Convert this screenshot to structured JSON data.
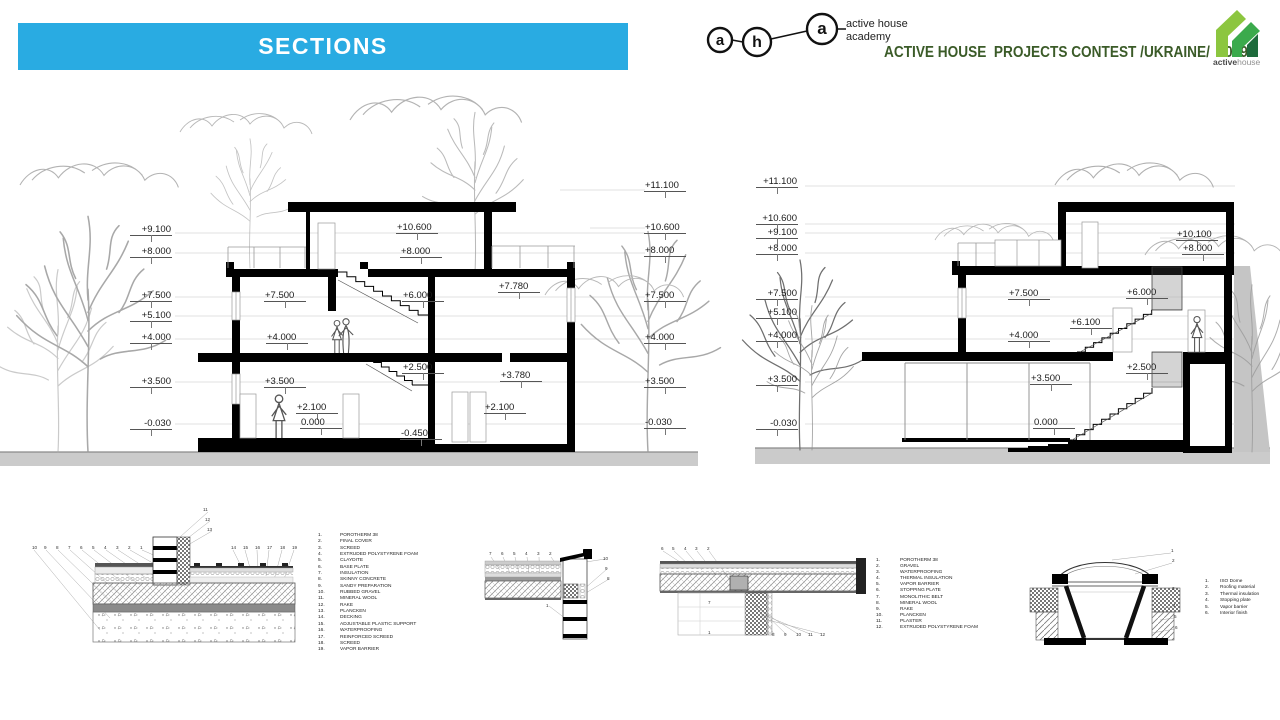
{
  "header": {
    "title": "SECTIONS",
    "aha": {
      "letters": [
        "a",
        "h",
        "a"
      ],
      "caption_line1": "active house",
      "caption_line2": "academy"
    },
    "contest_line": "ACTIVE HOUSE  PROJECTS CONTEST /UKRAINE/  2019",
    "brand": {
      "bold": "active",
      "light": "house"
    },
    "colors": {
      "banner_blue": "#29ABE2",
      "contest_green": "#3B5B28",
      "logo_light_green": "#8CC63F",
      "logo_mid_green": "#3BAA4C",
      "logo_dark_green": "#1E6B3C"
    }
  },
  "sections": [
    {
      "name": "section-1",
      "left_labels": [
        "+9.100",
        "+8.000",
        "+7.500",
        "+5.100",
        "+4.000",
        "+3.500",
        "-0.030"
      ],
      "right_labels": [
        "+11.100",
        "+10.600",
        "+8.000",
        "+7.500",
        "+4.000",
        "+3.500",
        "-0.030"
      ],
      "interior_labels": [
        "+10.600",
        "+8.000",
        "+7.500",
        "+6.000",
        "+7.780",
        "+4.000",
        "+2.500",
        "+3.500",
        "+3.780",
        "+2.100",
        "0.000",
        "+2.100",
        "-0.450"
      ]
    },
    {
      "name": "section-2",
      "left_labels": [
        "+11.100",
        "+10.600",
        "+9.100",
        "+8.000",
        "+7.500",
        "+5.100",
        "+4.000",
        "+3.500",
        "-0.030"
      ],
      "right_labels": [
        "+10.100",
        "+8.000"
      ],
      "interior_labels": [
        "+7.500",
        "+6.000",
        "+6.100",
        "+4.000",
        "+3.500",
        "+2.500",
        "0.000"
      ]
    }
  ],
  "details": [
    {
      "name": "floor-terrace-junction-detail",
      "callouts": [
        "10",
        "9",
        "8",
        "7",
        "6",
        "5",
        "4",
        "3",
        "2",
        "1",
        "11",
        "12",
        "13",
        "14",
        "15",
        "16",
        "17",
        "18",
        "19"
      ],
      "legend": [
        "POROTHERM 38",
        "FINAL COVER",
        "SCREED",
        "EXTRUDED POLYSTYRENE FOAM",
        "CLAYDITE",
        "BASE PLATE",
        "INSULATION",
        "SKINNY CONCRETE",
        "SANDY PREPARATION",
        "RUBBED GRAVEL",
        "MINERAL WOOL",
        "RAKE",
        "PLANCKEN",
        "DECKING",
        "ADJUSTABLE PLASTIC SUPPORT",
        "WATERPROOFING",
        "REINFORCED SCREED",
        "SCREED",
        "VAPOR BARRIER"
      ]
    },
    {
      "name": "parapet-detail",
      "callouts": [
        "7",
        "6",
        "5",
        "4",
        "3",
        "2",
        "10",
        "9",
        "8",
        "1"
      ],
      "legend": []
    },
    {
      "name": "roof-overhang-detail",
      "callouts": [
        "6",
        "5",
        "4",
        "3",
        "2",
        "7",
        "1",
        "8",
        "9",
        "10",
        "11",
        "12"
      ],
      "legend": [
        "POROTHERM 38",
        "GRAVEL",
        "WATERPROOFING",
        "THERMAL INSULATION",
        "VAPOR BARRIER",
        "STOPPING PLATE",
        "MONOLITHIC BELT",
        "MINERAL WOOL",
        "RAKE",
        "PLANCKEN",
        "PLASTER",
        "EXTRUDED POLYSTYRENE FOAM"
      ]
    },
    {
      "name": "skylight-dome-detail",
      "callouts": [
        "1",
        "2",
        "3",
        "4",
        "5",
        "6"
      ],
      "legend": [
        "ISO Dome",
        "Roofing material",
        "Thermal insulation",
        "Stopping plate",
        "Vapor barrier",
        "Interior finish"
      ]
    }
  ]
}
